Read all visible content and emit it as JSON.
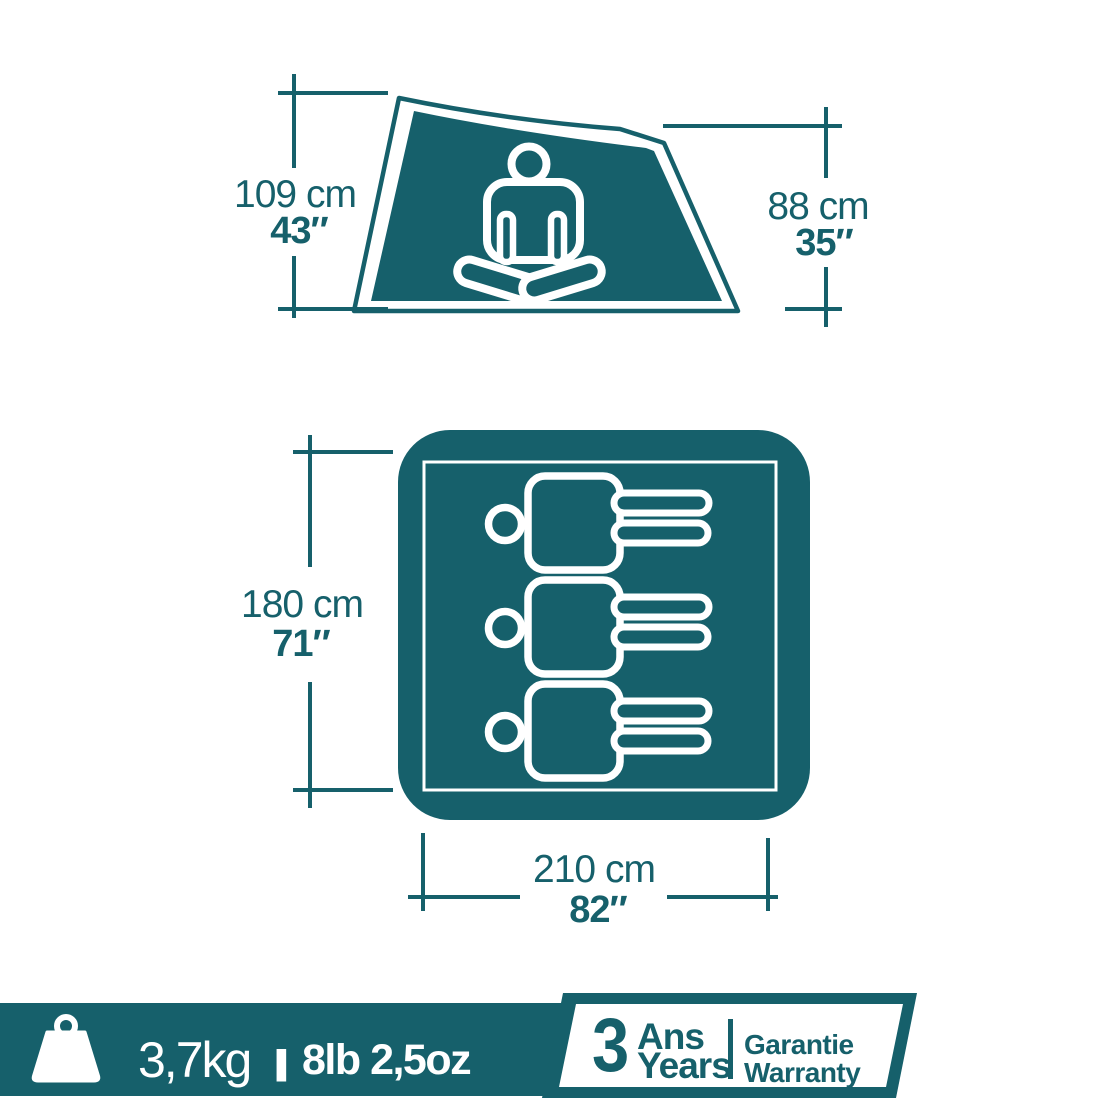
{
  "colors": {
    "teal": "#16606B",
    "white": "#FFFFFF",
    "background": "#FFFFFF"
  },
  "side_view": {
    "left_dimension": {
      "metric": "109 cm",
      "imperial": "43″"
    },
    "right_dimension": {
      "metric": "88 cm",
      "imperial": "35″"
    }
  },
  "floor_plan": {
    "side_dimension": {
      "metric": "180 cm",
      "imperial": "71″"
    },
    "bottom_dimension": {
      "metric": "210 cm",
      "imperial": "82″"
    },
    "sleeper_count": "3"
  },
  "footer": {
    "weight_metric": "3,7kg",
    "weight_divider": "|",
    "weight_imperial": "8lb 2,5oz",
    "warranty": {
      "years_value": "3",
      "years_label_fr": "Ans",
      "years_label_en": "Years",
      "guarantee_fr": "Garantie",
      "guarantee_en": "Warranty"
    }
  }
}
